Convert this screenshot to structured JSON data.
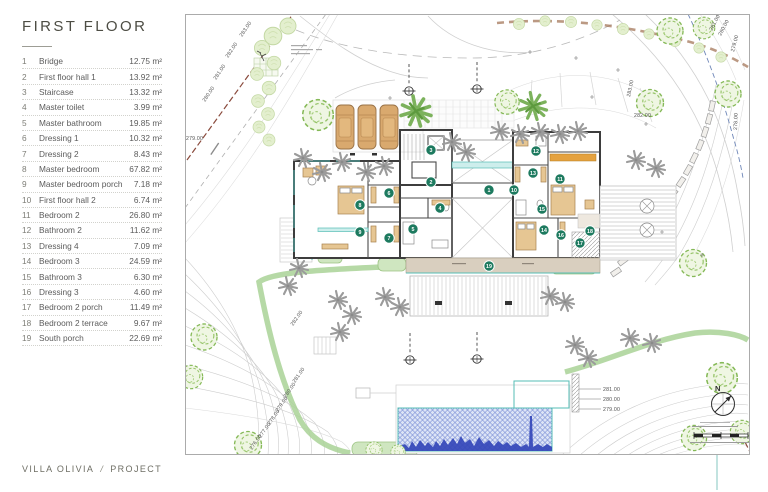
{
  "sidebar": {
    "title": "FIRST FLOOR",
    "rooms": [
      {
        "num": "1",
        "name": "Bridge",
        "area": "12.75 m²"
      },
      {
        "num": "2",
        "name": "First floor hall 1",
        "area": "13.92 m²"
      },
      {
        "num": "3",
        "name": "Staircase",
        "area": "13.32 m²"
      },
      {
        "num": "4",
        "name": "Master toilet",
        "area": "3.99 m²"
      },
      {
        "num": "5",
        "name": "Master bathroom",
        "area": "19.85 m²"
      },
      {
        "num": "6",
        "name": "Dressing 1",
        "area": "10.32 m²"
      },
      {
        "num": "7",
        "name": "Dressing 2",
        "area": "8.43 m²"
      },
      {
        "num": "8",
        "name": "Master bedroom",
        "area": "67.82 m²"
      },
      {
        "num": "9",
        "name": "Master bedroom porch",
        "area": "7.18 m²"
      },
      {
        "num": "10",
        "name": "First floor hall 2",
        "area": "6.74 m²"
      },
      {
        "num": "11",
        "name": "Bedroom 2",
        "area": "26.80 m²"
      },
      {
        "num": "12",
        "name": "Bathroom 2",
        "area": "11.62 m²"
      },
      {
        "num": "13",
        "name": "Dressing 4",
        "area": "7.09 m²"
      },
      {
        "num": "14",
        "name": "Bedroom 3",
        "area": "24.59 m²"
      },
      {
        "num": "15",
        "name": "Bathroom 3",
        "area": "6.30 m²"
      },
      {
        "num": "16",
        "name": "Dressing 3",
        "area": "4.60 m²"
      },
      {
        "num": "17",
        "name": "Bedroom 2 porch",
        "area": "11.49 m²"
      },
      {
        "num": "18",
        "name": "Bedroom 2 terrace",
        "area": "9.67 m²"
      },
      {
        "num": "19",
        "name": "South porch",
        "area": "22.69 m²"
      }
    ]
  },
  "footer": {
    "project": "VILLA OLIVIA",
    "separator": "/",
    "section": "PROJECT"
  },
  "plan": {
    "north_label": "N",
    "colors": {
      "marker": "#1d7a5f",
      "teal": "#56bdb6",
      "pool_blue": "#3347b8",
      "boundary_red": "#8a4a3c"
    },
    "markers": [
      {
        "num": "1",
        "x": 489,
        "y": 190
      },
      {
        "num": "2",
        "x": 431,
        "y": 182
      },
      {
        "num": "3",
        "x": 431,
        "y": 150
      },
      {
        "num": "4",
        "x": 440,
        "y": 208
      },
      {
        "num": "5",
        "x": 413,
        "y": 229
      },
      {
        "num": "6",
        "x": 389,
        "y": 193
      },
      {
        "num": "7",
        "x": 389,
        "y": 238
      },
      {
        "num": "8",
        "x": 360,
        "y": 205
      },
      {
        "num": "9",
        "x": 360,
        "y": 232
      },
      {
        "num": "10",
        "x": 514,
        "y": 190
      },
      {
        "num": "11",
        "x": 560,
        "y": 179
      },
      {
        "num": "12",
        "x": 536,
        "y": 151
      },
      {
        "num": "13",
        "x": 533,
        "y": 173
      },
      {
        "num": "14",
        "x": 544,
        "y": 230
      },
      {
        "num": "15",
        "x": 542,
        "y": 209
      },
      {
        "num": "16",
        "x": 561,
        "y": 235
      },
      {
        "num": "17",
        "x": 580,
        "y": 243
      },
      {
        "num": "18",
        "x": 590,
        "y": 231
      },
      {
        "num": "19",
        "x": 489,
        "y": 266
      }
    ],
    "elevations": [
      {
        "t": "283.00",
        "x": 242,
        "y": 37,
        "r": -56
      },
      {
        "t": "282.00",
        "x": 228,
        "y": 58,
        "r": -56
      },
      {
        "t": "281.00",
        "x": 216,
        "y": 80,
        "r": -56
      },
      {
        "t": "280.00",
        "x": 205,
        "y": 102,
        "r": -56
      },
      {
        "t": "279.00",
        "x": 186,
        "y": 140,
        "r": 0
      },
      {
        "t": "283.00",
        "x": 630,
        "y": 97,
        "r": -78
      },
      {
        "t": "282.00",
        "x": 634,
        "y": 117,
        "r": 0
      },
      {
        "t": "281.00",
        "x": 712,
        "y": 31,
        "r": -62
      },
      {
        "t": "280.00",
        "x": 721,
        "y": 36,
        "r": -62
      },
      {
        "t": "279.00",
        "x": 734,
        "y": 52,
        "r": -75
      },
      {
        "t": "278.00",
        "x": 737,
        "y": 130,
        "r": -88
      },
      {
        "t": "281.00",
        "x": 603,
        "y": 391,
        "r": 0
      },
      {
        "t": "280.00",
        "x": 603,
        "y": 401,
        "r": 0
      },
      {
        "t": "279.00",
        "x": 603,
        "y": 411,
        "r": 0
      },
      {
        "t": "282.00",
        "x": 293,
        "y": 326,
        "r": -55
      },
      {
        "t": "281.00",
        "x": 295,
        "y": 383,
        "r": -55
      },
      {
        "t": "280.00",
        "x": 286,
        "y": 398,
        "r": -55
      },
      {
        "t": "279.00",
        "x": 278,
        "y": 412,
        "r": -55
      },
      {
        "t": "278.00",
        "x": 270,
        "y": 425,
        "r": -55
      },
      {
        "t": "277.00",
        "x": 261,
        "y": 438,
        "r": -55
      },
      {
        "t": "276.00",
        "x": 252,
        "y": 450,
        "r": -55
      }
    ]
  }
}
